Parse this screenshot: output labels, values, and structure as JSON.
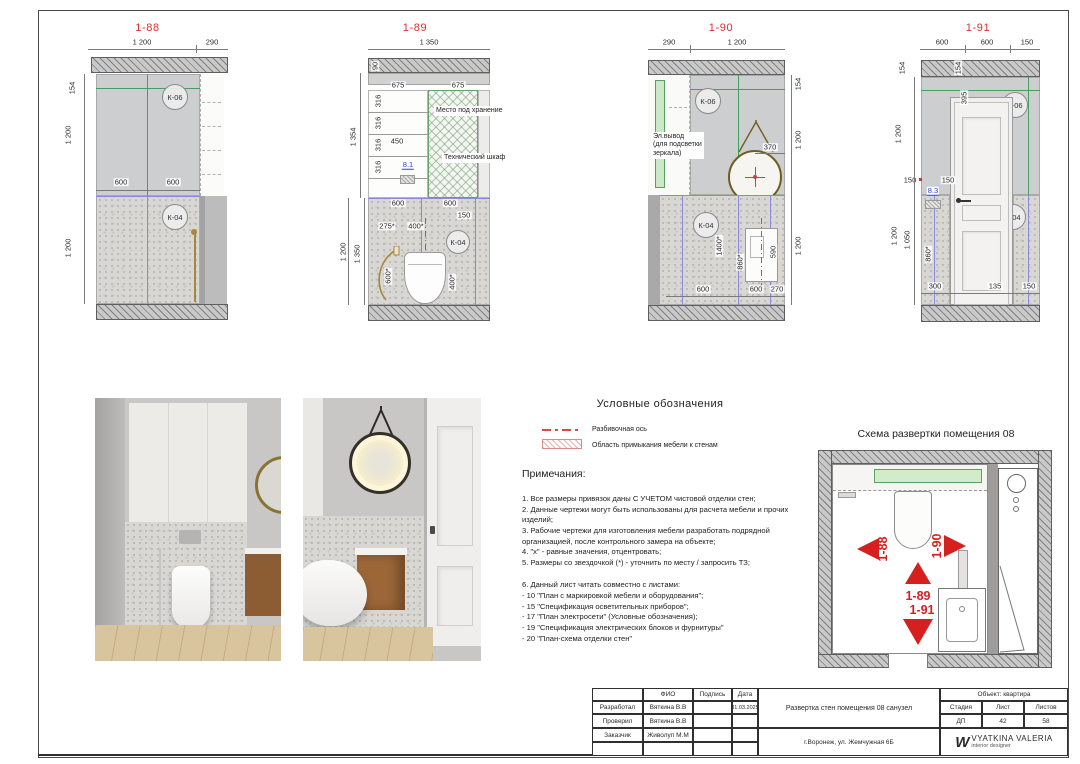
{
  "e88": {
    "title": "1-88",
    "d_top1": "1 200",
    "d_top2": "290",
    "d_l1": "154",
    "d_l2": "1 200",
    "d_l3": "1 200",
    "d_600a": "600",
    "d_600b": "600",
    "k06": "К-06",
    "k04": "К-04"
  },
  "e89": {
    "title": "1-89",
    "d_top": "1 350",
    "d_90": "90",
    "d_1354": "1 354",
    "d_1200": "1 200",
    "d_1350": "1 350",
    "d_675a": "675",
    "d_675b": "675",
    "d_316a": "316",
    "d_316b": "316",
    "d_316c": "316",
    "d_316d": "316",
    "d_450": "450",
    "ref": "8.1",
    "lbl_storage": "Место под хранение",
    "lbl_tech": "Технический шкаф",
    "d_600a": "600",
    "d_600b": "600",
    "d_150": "150",
    "d_275": "275*",
    "d_400a": "400*",
    "d_600s": "600*",
    "d_400b": "400*",
    "k04": "К-04"
  },
  "e90": {
    "title": "1-90",
    "d_top1": "290",
    "d_top2": "1 200",
    "d_r1": "154",
    "d_r2": "1 200",
    "d_r3": "1 200",
    "d_370": "370",
    "lbl_el1": "Эл.вывод",
    "lbl_el2": "(для подсветки",
    "lbl_el3": "зеркала)",
    "k06": "К-06",
    "k04": "К-04",
    "d_1400": "1400*",
    "d_860": "860*",
    "d_590": "590",
    "d_600a": "600",
    "d_600b": "600",
    "d_270": "270"
  },
  "e91": {
    "title": "1-91",
    "d_top1": "600",
    "d_top2": "600",
    "d_top3": "150",
    "d_l154": "154",
    "d_l1200a": "1 200",
    "d_l150": "150",
    "d_l1200b": "1 200",
    "d_l1050": "1 050",
    "d_860": "860*",
    "d_300": "300",
    "ref": "8.3",
    "d_i154": "154",
    "d_395": "395",
    "d_i150": "150",
    "d_135": "135",
    "d_b150": "150",
    "k06": "К-06",
    "k04": "К-04"
  },
  "legend": {
    "title": "Условные обозначения",
    "axis_label": "Разбивочная ось",
    "hatch_label": "Область примыкания мебели к стенам"
  },
  "notes": {
    "title": "Примечания:",
    "items": [
      "1. Все размеры привязок даны С УЧЕТОМ чистовой отделки стен;",
      "2. Данные чертежи могут быть использованы для расчета мебели и прочих изделий;",
      "3. Рабочие чертежи для изготовления мебели разработать подрядной организацией, после контрольного замера на объекте;",
      "4. \"х\" - равные значения, отцентровать;",
      "5. Размеры со звездочкой (*) - уточнить по месту / запросить ТЗ;"
    ],
    "items2": [
      "6. Данный лист читать совместно с листами:",
      "- 10 \"План с маркировкой мебели и оборудования\";",
      "- 15 \"Спецификация осветительных приборов\";",
      "- 17 \"План электросети\" (Условные обозначения);",
      "- 19 \"Спецификация электрических блоков и фурнитуры\"",
      "- 20 \"План-схема отделки стен\""
    ]
  },
  "schema": {
    "title": "Схема развертки помещения 08",
    "a_left": "1-88",
    "a_right": "1-90",
    "a_down1": "1-89",
    "a_down2": "1-91"
  },
  "tb": {
    "h_fio": "ФИО",
    "h_sign": "Подпись",
    "h_date": "Дата",
    "r1_role": "Разработал",
    "r1_name": "Вяткина В.В",
    "r1_date": "31.03.2025",
    "r2_role": "Проверил",
    "r2_name": "Вяткина В.В",
    "r3_role": "Заказчик",
    "r3_name": "Живолуп М.М",
    "doc_title": "Развертка стен помещения 08 санузел",
    "address": "г.Воронеж, ул. Жемчужная 6Б",
    "object": "Объект: квартира",
    "h_stage": "Стадия",
    "h_sheet": "Лист",
    "h_sheets": "Листов",
    "stage": "ДП",
    "sheet": "42",
    "sheets": "58",
    "logo": "W",
    "brand": "VYATKINA VALERIA",
    "brand_sub": "interior designer"
  },
  "colors": {
    "accent_red": "#d92f2f",
    "ref_blue": "#2f3fd0",
    "axis_green": "#44a061",
    "tile_blue": "#8a8ad8"
  }
}
